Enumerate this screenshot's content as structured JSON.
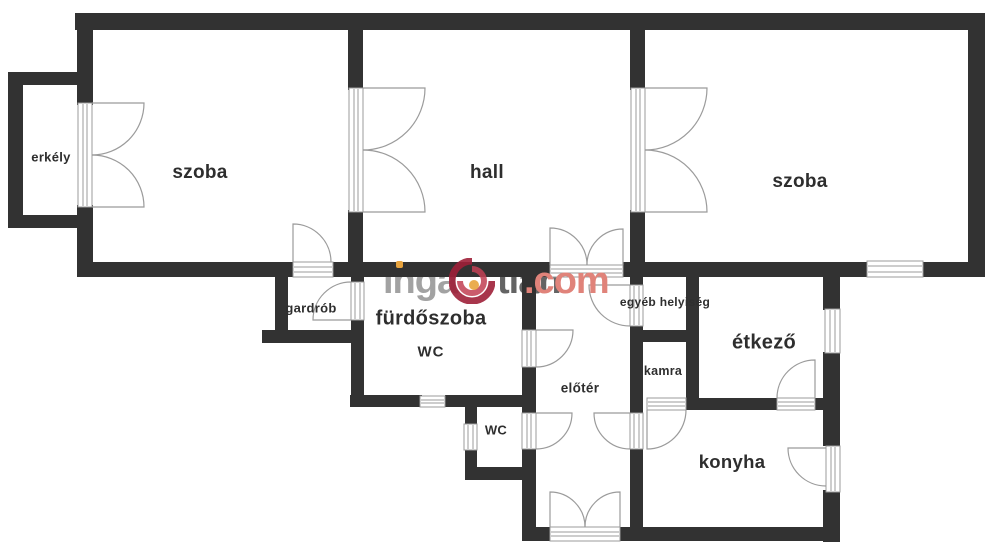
{
  "title": "apartment floor plan",
  "rooms": [
    {
      "id": "erkely",
      "label": "erkély"
    },
    {
      "id": "szoba-left",
      "label": "szoba"
    },
    {
      "id": "hall",
      "label": "hall"
    },
    {
      "id": "szoba-right",
      "label": "szoba"
    },
    {
      "id": "gardrob",
      "label": "gardrób"
    },
    {
      "id": "furdoszoba",
      "label": "fürdőszoba"
    },
    {
      "id": "furdoszoba-wc",
      "label": "WC"
    },
    {
      "id": "egyeb-helyiseg",
      "label": "egyéb helyiség"
    },
    {
      "id": "kamra",
      "label": "kamra"
    },
    {
      "id": "etkezo",
      "label": "étkező"
    },
    {
      "id": "eloter",
      "label": "előtér"
    },
    {
      "id": "wc",
      "label": "WC"
    },
    {
      "id": "konyha",
      "label": "konyha"
    }
  ],
  "watermark": {
    "part1": "inga",
    "part2": "tlan",
    "part3": ".com",
    "brand": "ingatlan.com"
  },
  "colors": {
    "wall": "#323232",
    "drawing_line": "#9b9b9b",
    "label_text": "#2e2e2e",
    "watermark_gray": "#a2a2a2",
    "watermark_red": "#e0837a",
    "logo_red": "#9e2038",
    "logo_orange": "#e8a33d",
    "background": "#ffffff"
  }
}
